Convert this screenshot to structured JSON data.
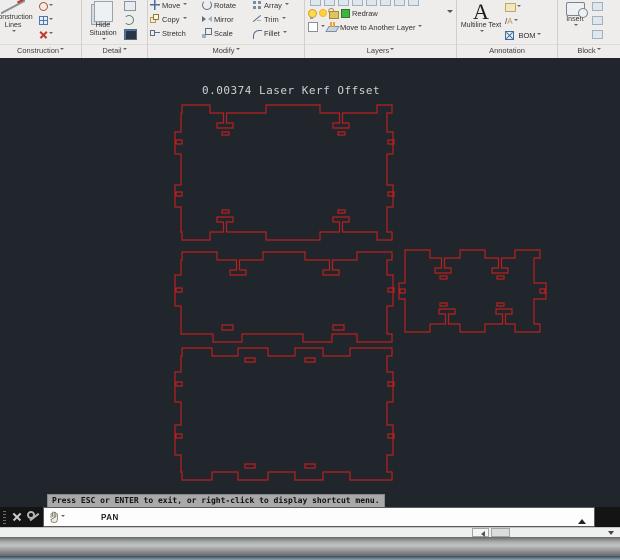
{
  "ribbon": {
    "construction": {
      "label": "Construction",
      "lines_label": "Construction Lines"
    },
    "detail": {
      "label": "Detail",
      "hide_label": "Hide Situation"
    },
    "modify": {
      "label": "Modify",
      "move": "Move",
      "rotate": "Rotate",
      "array": "Array",
      "copy": "Copy",
      "mirror": "Mirror",
      "trim": "Trim",
      "stretch": "Stretch",
      "scale": "Scale",
      "fillet": "Fillet"
    },
    "layers": {
      "label": "Layers",
      "redraw": "Redraw",
      "move_to": "Move to Another Layer"
    },
    "annotation": {
      "label": "Annotation",
      "a_glyph": "A",
      "multiline": "Multiline Text",
      "bom": "BOM"
    },
    "block": {
      "label": "Block",
      "insert": "Insert"
    }
  },
  "canvas": {
    "title": "0.00374 Laser Kerf Offset",
    "bg": "#20262c",
    "line_color": "#b82020",
    "panels": [
      {
        "name": "top-side-panel",
        "d": "M182 51 V43 H210 V51 H223.5 V61 H217 V66 H233 V61 H226.5 V51 H266 V43 H320 V51 H339.5 V61 H333 V66 H349 V61 H342.5 V51 H377 V43 H392 V51 H387 V70 H393 V92 H387 V123 H393 V145 H387 V170 H392 V178 H377 V170 H342.5 V160 H349 V155 H333 V160 H339.5 V170 H320 V178 H266 V170 H226.5 V160 H233 V155 H217 V160 H223.5 V170 H210 V178 H182 V170 H181 V145 H175 V123 H181 V92 H175 V70 H181 V51 Z M176 78 h6 v4 h-6 Z M176 130 h6 v4 h-6 Z M388 78 h6 v4 h-6 Z M388 130 h6 v4 h-6 Z M222 70 h7 v3 h-7 Z M338 70 h7 v3 h-7 Z M222 148 h7 v3 h-7 Z M338 148 h7 v3 h-7 Z"
      },
      {
        "name": "middle-side-panel",
        "d": "M182 198 V190 H217 V198 H236.5 V208 H230 V213 H246 V208 H239.5 V198 H263 V190 H305 V198 H329.5 V208 H323 V213 H339 V208 H332.5 V198 H357 V190 H392 V198 H387 V213 H393 V244 H387 V272 H392 V280 H357 V272 H332 V280 H303 V272 H242 V280 H213 V272 H181 V244 H175 V213 H181 V198 Z M222 263 h11 v5 h-11 Z M333 263 h11 v5 h-11 Z M176 226 h6 v4 h-6 Z M388 226 h6 v4 h-6 Z"
      },
      {
        "name": "small-end-panel",
        "d": "M405 188 H430 V196 H441.5 V206 H435 V211 H451 V206 H444.5 V196 H460 V188 H485 V196 H498.5 V206 H492 V211 H508 V206 H501.5 V196 H515 V188 H540 V196 H534 V221 H546 V237 H534 V262 H540 V270 H515 V262 H505.5 V252 H512 V247 H496 V252 H502.5 V262 H485 V270 H460 V262 H448.5 V252 H455 V247 H439 V252 H445.5 V262 H430 V270 H405 V237 H399 V221 H405 V196 Z M540 227 h5 v4 h-5 Z M400 227 h5 v4 h-5 Z M440 214 h7 v3 h-7 Z M497 214 h7 v3 h-7 Z M440 241 h7 v3 h-7 Z M497 241 h7 v3 h-7 Z"
      },
      {
        "name": "bottom-large-panel",
        "d": "M182 294 V286 H212 V294 H238 V286 H268 V294 H295 V286 H323 V294 H350 V286 H392 V294 H387 V310 H393 V340 H387 V363 H393 V393 H387 V410 H392 V418 H350 V410 H323 V418 H295 V410 H268 V418 H238 V410 H212 V418 H182 V410 H181 V393 H175 V363 H181 V340 H175 V310 H181 V294 Z M245 296 h10 v4 h-10 Z M305 296 h10 v4 h-10 Z M245 402 h10 v4 h-10 Z M305 402 h10 v4 h-10 Z M176 320 h6 v4 h-6 Z M176 372 h6 v4 h-6 Z M388 320 h6 v4 h-6 Z M388 372 h6 v4 h-6 Z"
      }
    ]
  },
  "statusbar": {
    "tooltip": "Press ESC or ENTER to exit, or right-click to display shortcut menu.",
    "command": "PAN"
  }
}
